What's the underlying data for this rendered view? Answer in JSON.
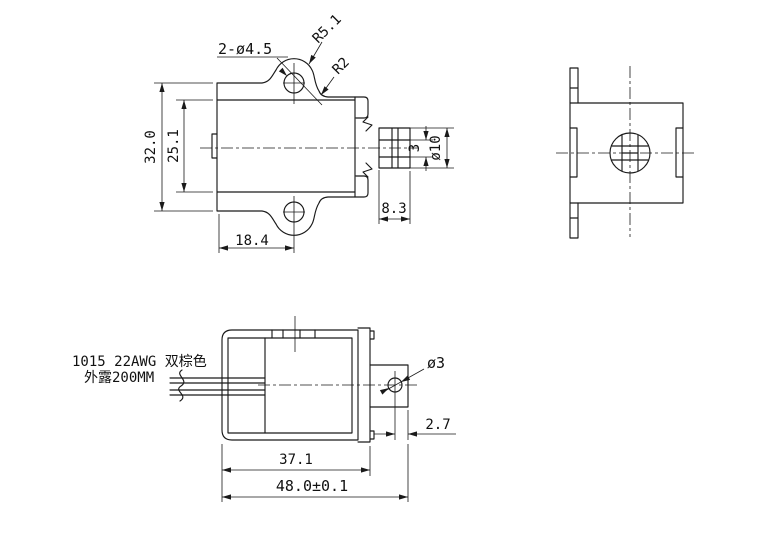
{
  "drawing": {
    "colors": {
      "line": "#1a1a1a",
      "background": "#ffffff"
    },
    "front_view": {
      "hole_callout": "2-ø4.5",
      "tab_radius": "R5.1",
      "fillet_radius": "R2",
      "overall_height": "32.0",
      "inner_height": "25.1",
      "hole_offset_width": "18.4",
      "plunger_extension": "8.3",
      "slot_width": "3",
      "plunger_diameter": "ø10"
    },
    "bottom_view": {
      "wire_spec_line1": "1015 22AWG 双棕色",
      "wire_spec_line2": "外露200MM",
      "pin_hole_diameter": "ø3",
      "hole_to_tip": "2.7",
      "body_length": "37.1",
      "overall_length": "48.0±0.1"
    }
  }
}
